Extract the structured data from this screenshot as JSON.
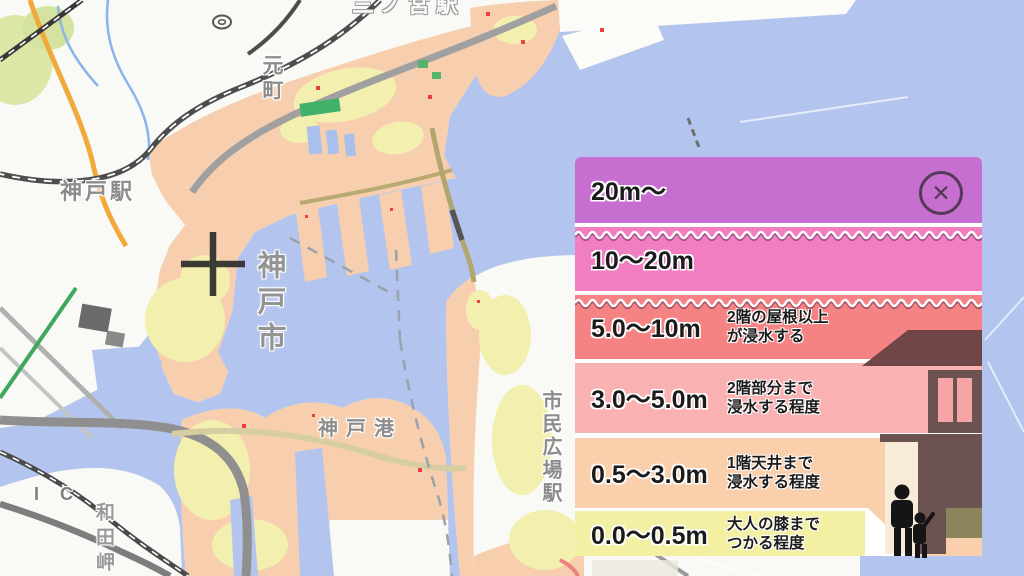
{
  "legend": {
    "title_hint": "flood depth legend",
    "close_icon": "✕",
    "rows": [
      {
        "range": "20m～",
        "desc1": "",
        "desc2": "",
        "color": "#c76fd1"
      },
      {
        "range": "10～20m",
        "desc1": "",
        "desc2": "",
        "color": "#f07ec0"
      },
      {
        "range": "5.0～10m",
        "desc1": "2階の屋根以上",
        "desc2": "が浸水する",
        "color": "#f58383"
      },
      {
        "range": "3.0～5.0m",
        "desc1": "2階部分まで",
        "desc2": "浸水する程度",
        "color": "#f9b1b1"
      },
      {
        "range": "0.5～3.0m",
        "desc1": "1階天井まで",
        "desc2": "浸水する程度",
        "color": "#facfab"
      },
      {
        "range": "0.0～0.5m",
        "desc1": "大人の膝まで",
        "desc2": "つかる程度",
        "color": "#f3f0a4"
      }
    ]
  },
  "map": {
    "labels": {
      "sannomiya_station": "三ノ宮駅",
      "motomachi": "元町",
      "kobe_station": "神戸駅",
      "kobe_city": "神戸市",
      "kobe_port": "神戸港",
      "shimin_hiroba_station": "市民広場駅",
      "interchange": "I C",
      "wadamisaki": "和田岬"
    },
    "colors": {
      "water": "#b3c5ee",
      "land": "#f9f9f6",
      "flood_shallow_yellow": "#f3efae",
      "flood_peach": "#f7cfae",
      "road_orange": "#f2a93b",
      "rail_dark": "#4d4d4d",
      "label_gray": "#8c8c8c"
    }
  }
}
